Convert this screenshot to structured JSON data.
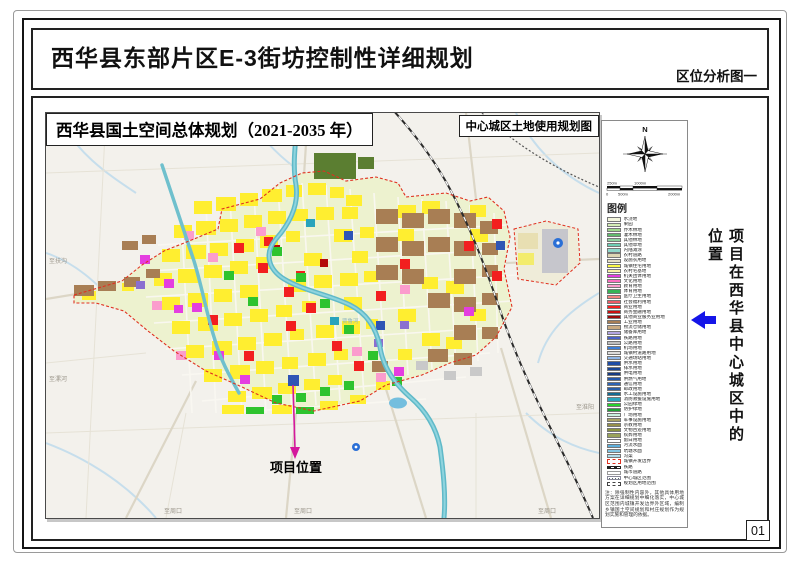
{
  "page": {
    "title": "西华县东部片区E-3街坊控制性详细规划",
    "subtitle": "区位分析图一",
    "page_number": "01"
  },
  "map": {
    "title": "西华县国土空间总体规划（2021-2035 年）",
    "corner_label": "中心城区土地使用规划图",
    "project_label": "项目位置",
    "edge_labels": {
      "nw": "至扶沟",
      "w": "至漯河",
      "n": "至鄢陵",
      "s1": "至周口",
      "s2": "至周口",
      "e": "至淮阳",
      "se": "至周口",
      "river": "贾鲁河"
    }
  },
  "sidebar": {
    "text": "项目在西华县中心城区中的位置"
  },
  "legend": {
    "heading": "图例",
    "north_label": "N",
    "scale": {
      "t1": "250m",
      "t2": "1000m",
      "b1": "0",
      "b2": "500m",
      "b3": "2000m"
    },
    "items": [
      {
        "label": "水浇地",
        "color": "#f2f5dc"
      },
      {
        "label": "果园",
        "color": "#d3ecb4"
      },
      {
        "label": "乔木林地",
        "color": "#9ed98b"
      },
      {
        "label": "灌木林地",
        "color": "#63bb6e"
      },
      {
        "label": "其他林地",
        "color": "#8fd3a0"
      },
      {
        "label": "其他草地",
        "color": "#6fcdb4"
      },
      {
        "label": "内陆滩涂",
        "color": "#8fd8cb"
      },
      {
        "label": "农村道路",
        "color": "#ded6b4"
      },
      {
        "label": "设施农用地",
        "color": "#e7dfc5"
      },
      {
        "label": "城镇住宅用地",
        "color": "#fdf948"
      },
      {
        "label": "农村宅基地",
        "color": "#f7f2a5"
      },
      {
        "label": "机关团体用地",
        "color": "#e43ee0"
      },
      {
        "label": "文化用地",
        "color": "#fb6ec0"
      },
      {
        "label": "教育用地",
        "color": "#fb9ccd"
      },
      {
        "label": "体育用地",
        "color": "#36b456"
      },
      {
        "label": "医疗卫生用地",
        "color": "#f4827e"
      },
      {
        "label": "社会福利用地",
        "color": "#ee5a65"
      },
      {
        "label": "商业用地",
        "color": "#f91e1e"
      },
      {
        "label": "商务金融用地",
        "color": "#cc0f0f"
      },
      {
        "label": "其他商业服务业用地",
        "color": "#9d0a0a"
      },
      {
        "label": "工业用地",
        "color": "#a87e54"
      },
      {
        "label": "物流仓储用地",
        "color": "#c9aa80"
      },
      {
        "label": "储备库用地",
        "color": "#b4a6e2"
      },
      {
        "label": "铁路用地",
        "color": "#4a62c8"
      },
      {
        "label": "公路用地",
        "color": "#bfbfbf"
      },
      {
        "label": "机场用地",
        "color": "#3d7fd9"
      },
      {
        "label": "城镇村道路用地",
        "color": "#dcdcdc"
      },
      {
        "label": "交通场站用地",
        "color": "#8fb6e8"
      },
      {
        "label": "供水用地",
        "color": "#1f4da6"
      },
      {
        "label": "排水用地",
        "color": "#1b4696"
      },
      {
        "label": "供电用地",
        "color": "#163a82"
      },
      {
        "label": "供燃气用地",
        "color": "#2456aa"
      },
      {
        "label": "通信用地",
        "color": "#2c63b4"
      },
      {
        "label": "邮政用地",
        "color": "#2a5ea8"
      },
      {
        "label": "水工设施用地",
        "color": "#136a92"
      },
      {
        "label": "消防救援设施用地",
        "color": "#2aa3bc"
      },
      {
        "label": "公园绿地",
        "color": "#27d32c"
      },
      {
        "label": "防护绿地",
        "color": "#1fa335"
      },
      {
        "label": "广场用地",
        "color": "#c9f0df"
      },
      {
        "label": "军事设施用地",
        "color": "#a8a263"
      },
      {
        "label": "宗教用地",
        "color": "#96904a"
      },
      {
        "label": "文物古迹用地",
        "color": "#8a9340"
      },
      {
        "label": "殡葬用地",
        "color": "#9aa35a"
      },
      {
        "label": "留白用地",
        "color": "#ffffff"
      },
      {
        "label": "河流水面",
        "color": "#5fb0dc"
      },
      {
        "label": "坑塘水面",
        "color": "#83c6e4"
      },
      {
        "label": "沟渠",
        "color": "#b0dcec"
      }
    ],
    "special_items": [
      {
        "label": "城镇开发边界",
        "style": "dashed-red"
      },
      {
        "label": "铁路",
        "style": "rail"
      },
      {
        "label": "城市道路",
        "style": "road"
      },
      {
        "label": "中心城区范围",
        "style": "dots"
      },
      {
        "label": "规划区用地范围",
        "style": "dashdot"
      }
    ],
    "note": "注：除强制性内容外，其他具体用地方案在详细规划中细化落实，中心城区范围内城镇开发边界外区域，编制乡镇国土空间规划和村庄规划作为规划实施和管理的依据。"
  },
  "colors": {
    "accent_arrow": "#1515e8",
    "project_arrow": "#d4189c",
    "boundary": "#e03020"
  }
}
